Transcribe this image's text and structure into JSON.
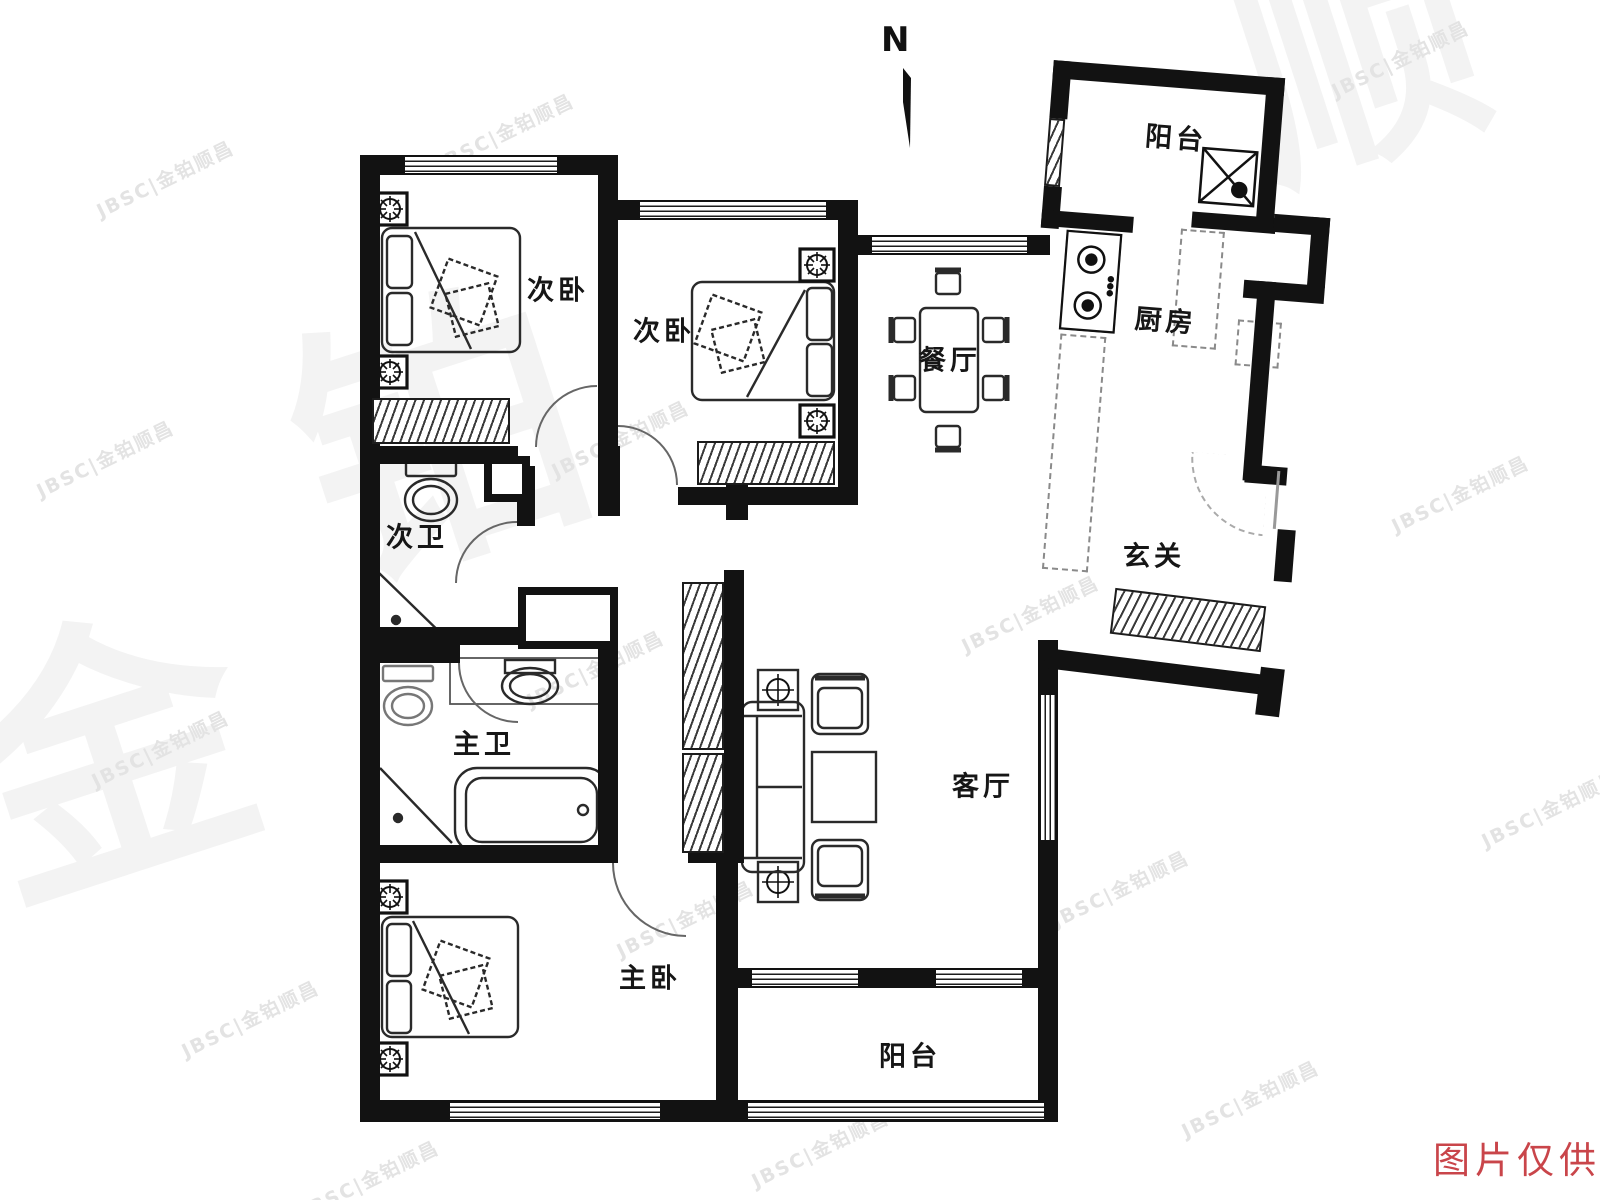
{
  "page": {
    "type": "apartment-floor-plan"
  },
  "compass": {
    "label": "N"
  },
  "rooms": {
    "bedroom_second_1": {
      "label": "次卧"
    },
    "bedroom_second_2": {
      "label": "次卧"
    },
    "dining": {
      "label": "餐厅"
    },
    "kitchen": {
      "label": "厨房"
    },
    "balcony_north": {
      "label": "阳台"
    },
    "entry": {
      "label": "玄关"
    },
    "bath_second": {
      "label": "次卫"
    },
    "bath_master": {
      "label": "主卫"
    },
    "living": {
      "label": "客厅"
    },
    "bedroom_master": {
      "label": "主卧"
    },
    "balcony_south": {
      "label": "阳台"
    }
  },
  "watermark": {
    "text": "JBSC|金铂顺昌",
    "big": [
      "金",
      "铂",
      "顺"
    ]
  },
  "disclaimer": {
    "text": "图片仅供参考"
  },
  "colors": {
    "wall": "#121212",
    "furniture_line": "#2a2a2a",
    "watermark": "#e3e3e3",
    "disclaimer_red": "#c9454a"
  }
}
